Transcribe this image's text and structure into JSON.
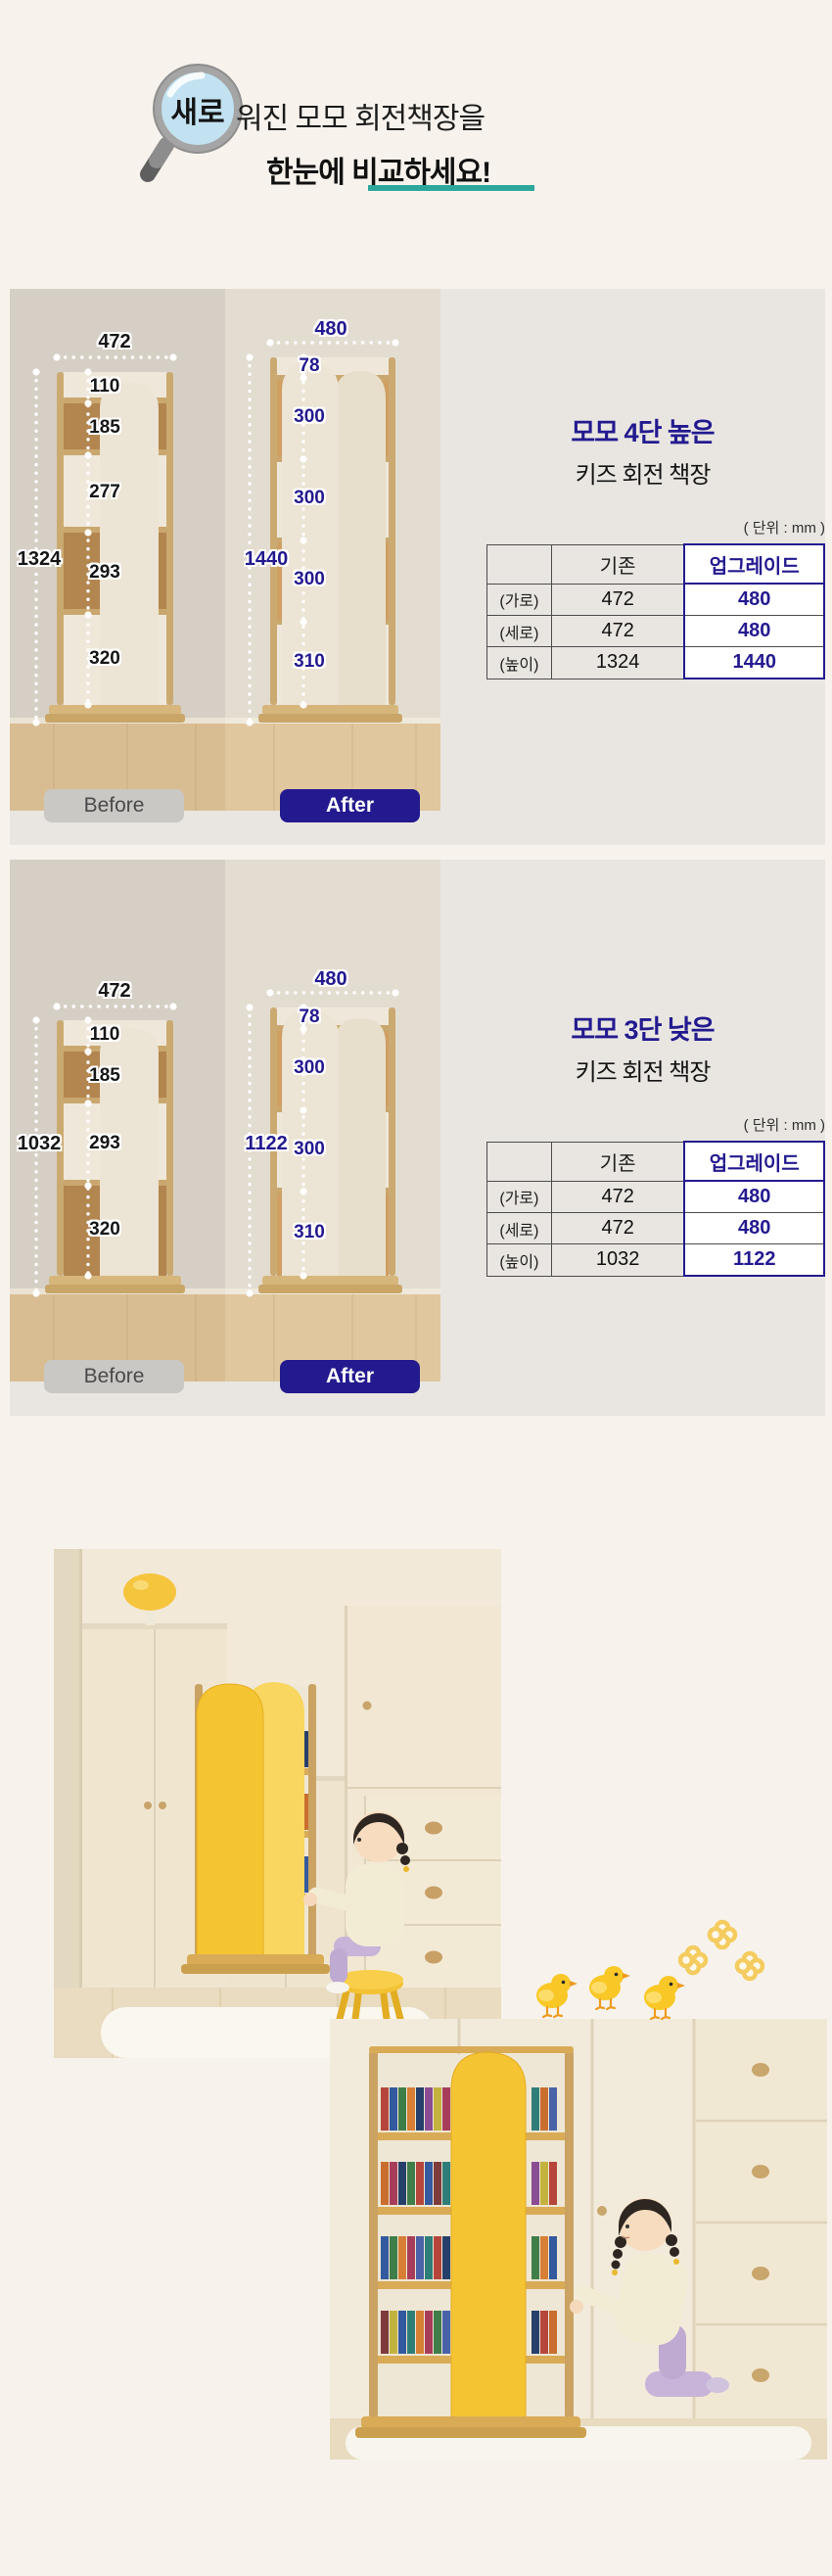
{
  "colors": {
    "page_bg": "#f7f3ec",
    "panel_bg": "#e9e6e2",
    "navy": "#231a8f",
    "teal": "#2da79c",
    "before_label_bg": "#c9c8c5",
    "shelf_yellow": "#f5c433"
  },
  "header": {
    "magnifier_icon": "magnifier-icon",
    "magnifier_text": "새로",
    "title_rest": "워진 모모 회전책장을",
    "title_line2": "한눈에 비교하세요!"
  },
  "sections": [
    {
      "title_line1": "모모 4단 높은",
      "title_line2": "키즈 회전 책장",
      "unit_note": "( 단위 : mm )",
      "before_label": "Before",
      "after_label": "After",
      "before": {
        "width": "472",
        "segments": [
          "110",
          "185",
          "277",
          "293",
          "320"
        ],
        "total": "1324"
      },
      "after": {
        "width": "480",
        "segments": [
          "78",
          "300",
          "300",
          "300",
          "310"
        ],
        "total": "1440"
      },
      "table": {
        "headers": [
          "",
          "기존",
          "업그레이드"
        ],
        "rows": [
          {
            "label": "(가로)",
            "old": "472",
            "new": "480"
          },
          {
            "label": "(세로)",
            "old": "472",
            "new": "480"
          },
          {
            "label": "(높이)",
            "old": "1324",
            "new": "1440"
          }
        ]
      }
    },
    {
      "title_line1": "모모 3단 낮은",
      "title_line2": "키즈 회전 책장",
      "unit_note": "( 단위 : mm )",
      "before_label": "Before",
      "after_label": "After",
      "before": {
        "width": "472",
        "segments": [
          "110",
          "185",
          "293",
          "320"
        ],
        "total": "1032"
      },
      "after": {
        "width": "480",
        "segments": [
          "78",
          "300",
          "300",
          "310"
        ],
        "total": "1122"
      },
      "table": {
        "headers": [
          "",
          "기존",
          "업그레이드"
        ],
        "rows": [
          {
            "label": "(가로)",
            "old": "472",
            "new": "480"
          },
          {
            "label": "(세로)",
            "old": "472",
            "new": "480"
          },
          {
            "label": "(높이)",
            "old": "1032",
            "new": "1122"
          }
        ]
      }
    }
  ],
  "gallery": {
    "decoration_icons": [
      "chick-icon",
      "chick-icon",
      "chick-icon",
      "flower-icon",
      "flower-icon",
      "flower-icon"
    ]
  }
}
